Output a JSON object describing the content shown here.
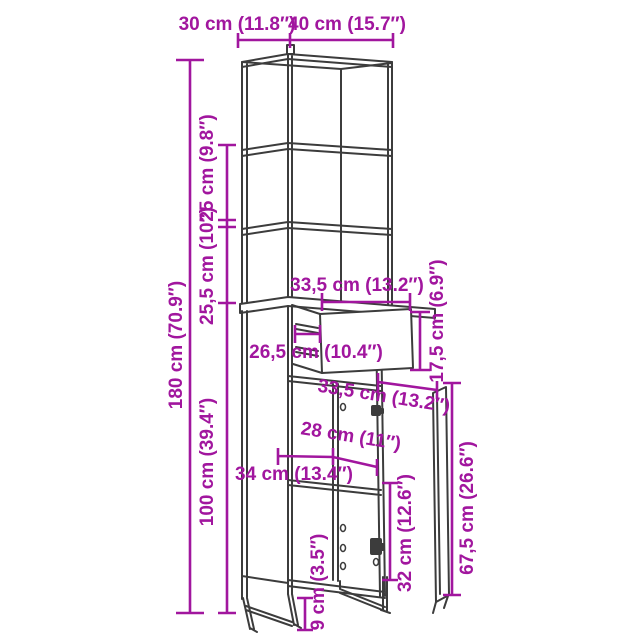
{
  "colors": {
    "background": "#ffffff",
    "artwork_line": "#3c3c3c",
    "dimension_accent": "#a1169e"
  },
  "diagram": {
    "type": "furniture-dimension-diagram",
    "dims": {
      "top_depth": "30 cm (11.8″)",
      "top_width": "40 cm (15.7″)",
      "total_height": "180 cm (70.9″)",
      "upper_shelf_spacing": "25 cm (9.8″)",
      "lower_shelf_spacing": "25,5 cm (10″)",
      "lower_unit_height": "100 cm (39.4″)",
      "drawer_width": "33,5 cm (13.2″)",
      "drawer_pullout": "26,5 cm (10.4″)",
      "drawer_front_height": "17,5 cm (6.9″)",
      "door_width": "33,5 cm (13.2″)",
      "inner_width": "28 cm (11″)",
      "base_depth": "34 cm (13.4″)",
      "compartment_height": "32 cm (12.6″)",
      "door_height": "67,5 cm (26.6″)",
      "leg_height": "9 cm (3.5″)"
    }
  }
}
